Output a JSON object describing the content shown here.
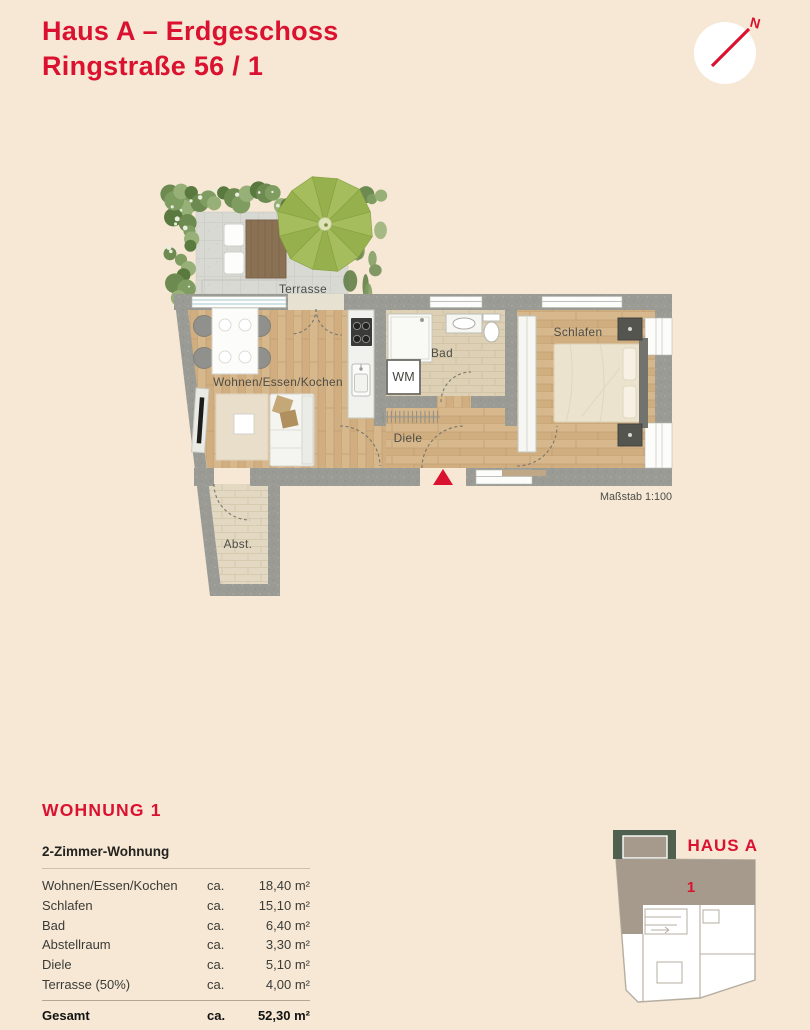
{
  "header": {
    "title_line1": "Haus A – Erdgeschoss",
    "title_line2": "Ringstraße 56 / 1",
    "compass_n": "N"
  },
  "floorplan": {
    "rooms": {
      "terrace": "Terrasse",
      "living": "Wohnen/Essen/Kochen",
      "bath": "Bad",
      "wm": "WM",
      "hall": "Diele",
      "bedroom": "Schlafen",
      "storage": "Abst."
    },
    "scale_label": "Maßstab 1:100"
  },
  "apartment": {
    "title": "WOHNUNG 1",
    "subtitle": "2-Zimmer-Wohnung",
    "rows": [
      {
        "name": "Wohnen/Essen/Kochen",
        "ca": "ca.",
        "area": "18,40 m²"
      },
      {
        "name": "Schlafen",
        "ca": "ca.",
        "area": "15,10 m²"
      },
      {
        "name": "Bad",
        "ca": "ca.",
        "area": "6,40 m²"
      },
      {
        "name": "Abstellraum",
        "ca": "ca.",
        "area": "3,30 m²"
      },
      {
        "name": "Diele",
        "ca": "ca.",
        "area": "5,10 m²"
      },
      {
        "name": "Terrasse (50%)",
        "ca": "ca.",
        "area": "4,00 m²"
      }
    ],
    "total": {
      "name": "Gesamt",
      "ca": "ca.",
      "area": "52,30 m²"
    }
  },
  "minimap": {
    "house_label": "HAUS A",
    "unit_number": "1"
  },
  "colors": {
    "accent": "#da1230",
    "background": "#f6e8d5",
    "wall": "#9b9b96",
    "wood": "#d7b78c",
    "bath_tile": "#ddd0b4",
    "terrace_paving": "#d9d9d4",
    "hedge_green": "#7f9c61",
    "umbrella_green": "#a5bd5c",
    "minimap_unit": "#a59a8b",
    "minimap_hedge": "#50604f"
  }
}
